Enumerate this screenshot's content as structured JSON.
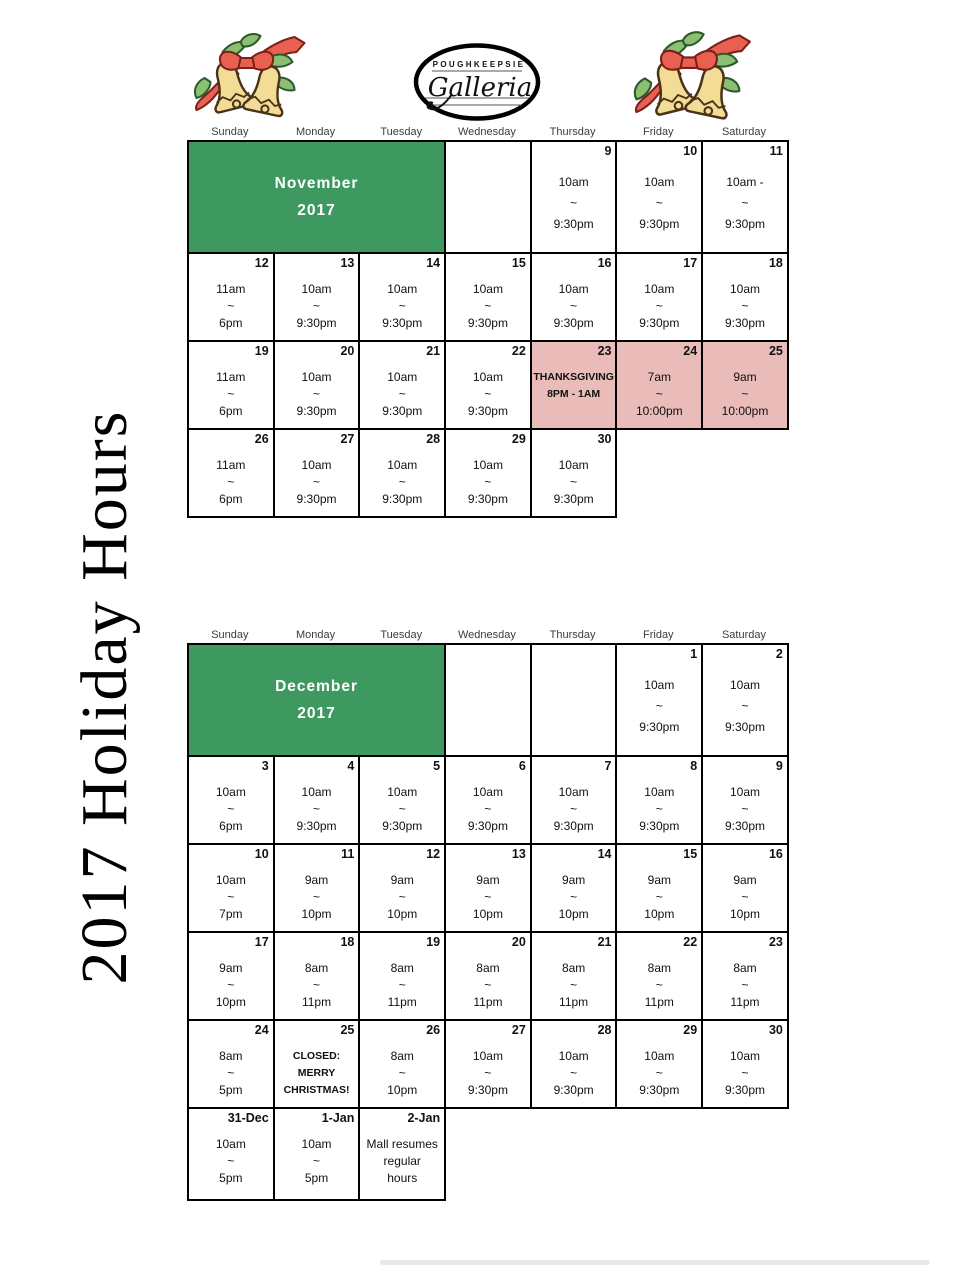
{
  "page": {
    "vertical_title": "2017 Holiday Hours"
  },
  "logo": {
    "top_text": "POUGHKEEPSIE",
    "script_text": "Galleria"
  },
  "colors": {
    "green": "#3e9960",
    "pink": "#e9bbb9"
  },
  "weekdays": [
    "Sunday",
    "Monday",
    "Tuesday",
    "Wednesday",
    "Thursday",
    "Friday",
    "Saturday"
  ],
  "calendars": [
    {
      "id": "november",
      "month_lines": [
        "November",
        "2017"
      ],
      "rows": [
        [
          {
            "type": "month",
            "colspan": 3
          },
          {
            "type": "empty"
          },
          {
            "type": "day",
            "date": "9",
            "lines": [
              "10am",
              "~",
              "9:30pm"
            ]
          },
          {
            "type": "day",
            "date": "10",
            "lines": [
              "10am",
              "~",
              "9:30pm"
            ]
          },
          {
            "type": "day",
            "date": "11",
            "lines": [
              "10am -",
              "~",
              "9:30pm"
            ]
          }
        ],
        [
          {
            "type": "day",
            "date": "12",
            "lines": [
              "11am",
              "~",
              "6pm"
            ]
          },
          {
            "type": "day",
            "date": "13",
            "lines": [
              "10am",
              "~",
              "9:30pm"
            ]
          },
          {
            "type": "day",
            "date": "14",
            "lines": [
              "10am",
              "~",
              "9:30pm"
            ]
          },
          {
            "type": "day",
            "date": "15",
            "lines": [
              "10am",
              "~",
              "9:30pm"
            ]
          },
          {
            "type": "day",
            "date": "16",
            "lines": [
              "10am",
              "~",
              "9:30pm"
            ]
          },
          {
            "type": "day",
            "date": "17",
            "lines": [
              "10am",
              "~",
              "9:30pm"
            ]
          },
          {
            "type": "day",
            "date": "18",
            "lines": [
              "10am",
              "~",
              "9:30pm"
            ]
          }
        ],
        [
          {
            "type": "day",
            "date": "19",
            "lines": [
              "11am",
              "~",
              "6pm"
            ]
          },
          {
            "type": "day",
            "date": "20",
            "lines": [
              "10am",
              "~",
              "9:30pm"
            ]
          },
          {
            "type": "day",
            "date": "21",
            "lines": [
              "10am",
              "~",
              "9:30pm"
            ]
          },
          {
            "type": "day",
            "date": "22",
            "lines": [
              "10am",
              "~",
              "9:30pm"
            ]
          },
          {
            "type": "day",
            "date": "23",
            "pink": true,
            "bold": true,
            "lines": [
              "THANKSGIVING",
              "8PM - 1AM"
            ]
          },
          {
            "type": "day",
            "date": "24",
            "pink": true,
            "lines": [
              "7am",
              "~",
              "10:00pm"
            ]
          },
          {
            "type": "day",
            "date": "25",
            "pink": true,
            "lines": [
              "9am",
              "~",
              "10:00pm"
            ]
          }
        ],
        [
          {
            "type": "day",
            "date": "26",
            "lines": [
              "11am",
              "~",
              "6pm"
            ]
          },
          {
            "type": "day",
            "date": "27",
            "lines": [
              "10am",
              "~",
              "9:30pm"
            ]
          },
          {
            "type": "day",
            "date": "28",
            "lines": [
              "10am",
              "~",
              "9:30pm"
            ]
          },
          {
            "type": "day",
            "date": "29",
            "lines": [
              "10am",
              "~",
              "9:30pm"
            ]
          },
          {
            "type": "day",
            "date": "30",
            "lines": [
              "10am",
              "~",
              "9:30pm"
            ]
          },
          {
            "type": "absent"
          },
          {
            "type": "absent"
          }
        ]
      ]
    },
    {
      "id": "december",
      "month_lines": [
        "December",
        "2017"
      ],
      "rows": [
        [
          {
            "type": "month",
            "colspan": 3
          },
          {
            "type": "empty"
          },
          {
            "type": "empty"
          },
          {
            "type": "day",
            "date": "1",
            "lines": [
              "10am",
              "~",
              "9:30pm"
            ]
          },
          {
            "type": "day",
            "date": "2",
            "lines": [
              "10am",
              "~",
              "9:30pm"
            ]
          }
        ],
        [
          {
            "type": "day",
            "date": "3",
            "lines": [
              "10am",
              "~",
              "6pm"
            ]
          },
          {
            "type": "day",
            "date": "4",
            "lines": [
              "10am",
              "~",
              "9:30pm"
            ]
          },
          {
            "type": "day",
            "date": "5",
            "lines": [
              "10am",
              "~",
              "9:30pm"
            ]
          },
          {
            "type": "day",
            "date": "6",
            "lines": [
              "10am",
              "~",
              "9:30pm"
            ]
          },
          {
            "type": "day",
            "date": "7",
            "lines": [
              "10am",
              "~",
              "9:30pm"
            ]
          },
          {
            "type": "day",
            "date": "8",
            "lines": [
              "10am",
              "~",
              "9:30pm"
            ]
          },
          {
            "type": "day",
            "date": "9",
            "lines": [
              "10am",
              "~",
              "9:30pm"
            ]
          }
        ],
        [
          {
            "type": "day",
            "date": "10",
            "lines": [
              "10am",
              "~",
              "7pm"
            ]
          },
          {
            "type": "day",
            "date": "11",
            "lines": [
              "9am",
              "~",
              "10pm"
            ]
          },
          {
            "type": "day",
            "date": "12",
            "lines": [
              "9am",
              "~",
              "10pm"
            ]
          },
          {
            "type": "day",
            "date": "13",
            "lines": [
              "9am",
              "~",
              "10pm"
            ]
          },
          {
            "type": "day",
            "date": "14",
            "lines": [
              "9am",
              "~",
              "10pm"
            ]
          },
          {
            "type": "day",
            "date": "15",
            "lines": [
              "9am",
              "~",
              "10pm"
            ]
          },
          {
            "type": "day",
            "date": "16",
            "lines": [
              "9am",
              "~",
              "10pm"
            ]
          }
        ],
        [
          {
            "type": "day",
            "date": "17",
            "lines": [
              "9am",
              "~",
              "10pm"
            ]
          },
          {
            "type": "day",
            "date": "18",
            "lines": [
              "8am",
              "~",
              "11pm"
            ]
          },
          {
            "type": "day",
            "date": "19",
            "lines": [
              "8am",
              "~",
              "11pm"
            ]
          },
          {
            "type": "day",
            "date": "20",
            "lines": [
              "8am",
              "~",
              "11pm"
            ]
          },
          {
            "type": "day",
            "date": "21",
            "lines": [
              "8am",
              "~",
              "11pm"
            ]
          },
          {
            "type": "day",
            "date": "22",
            "lines": [
              "8am",
              "~",
              "11pm"
            ]
          },
          {
            "type": "day",
            "date": "23",
            "lines": [
              "8am",
              "~",
              "11pm"
            ]
          }
        ],
        [
          {
            "type": "day",
            "date": "24",
            "lines": [
              "8am",
              "~",
              "5pm"
            ]
          },
          {
            "type": "day",
            "date": "25",
            "bold": true,
            "lines": [
              "CLOSED:",
              "MERRY",
              "CHRISTMAS!"
            ]
          },
          {
            "type": "day",
            "date": "26",
            "lines": [
              "8am",
              "~",
              "10pm"
            ]
          },
          {
            "type": "day",
            "date": "27",
            "lines": [
              "10am",
              "~",
              "9:30pm"
            ]
          },
          {
            "type": "day",
            "date": "28",
            "lines": [
              "10am",
              "~",
              "9:30pm"
            ]
          },
          {
            "type": "day",
            "date": "29",
            "lines": [
              "10am",
              "~",
              "9:30pm"
            ]
          },
          {
            "type": "day",
            "date": "30",
            "lines": [
              "10am",
              "~",
              "9:30pm"
            ]
          }
        ],
        [
          {
            "type": "day",
            "date": "31-Dec",
            "lines": [
              "10am",
              "~",
              "5pm"
            ]
          },
          {
            "type": "day",
            "date": "1-Jan",
            "lines": [
              "10am",
              "~",
              "5pm"
            ]
          },
          {
            "type": "day",
            "date": "2-Jan",
            "lines": [
              "Mall resumes",
              "regular",
              "hours"
            ]
          },
          {
            "type": "absent"
          },
          {
            "type": "absent"
          },
          {
            "type": "absent"
          },
          {
            "type": "absent"
          }
        ]
      ]
    }
  ]
}
